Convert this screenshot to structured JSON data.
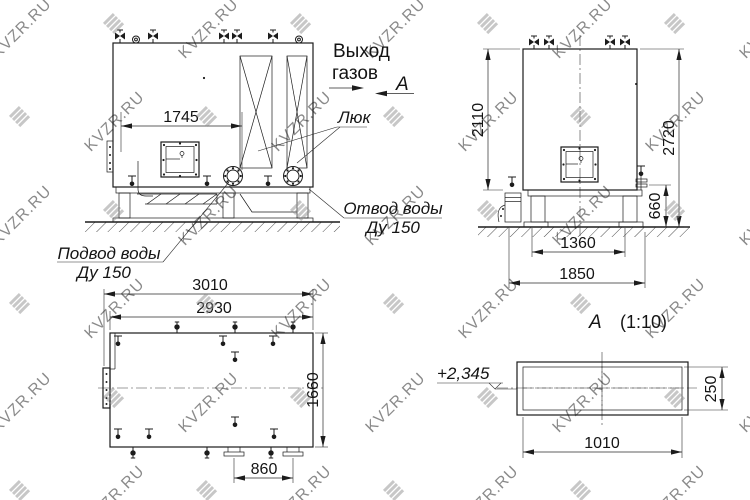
{
  "watermark": {
    "text": "KVZR.RU"
  },
  "labels": {
    "gas_outlet_1": "Выход",
    "gas_outlet_2": "газов",
    "section_arrow_letter": "А",
    "hatch": "Люк",
    "water_outlet_1": "Отвод воды",
    "water_outlet_2": "Ду 150",
    "water_inlet_1": "Подвод воды",
    "water_inlet_2": "Ду 150",
    "section_title_letter": "А",
    "section_title_scale": "(1:10)",
    "elevation": "+2,345"
  },
  "dimensions": {
    "front_width": "1745",
    "side_body_height": "2110",
    "side_overall_height": "2720",
    "side_base_height": "660",
    "side_base_inner_width": "1360",
    "side_base_overall_width": "1850",
    "top_overall_length": "3010",
    "top_body_length": "2930",
    "top_width": "1660",
    "top_pipe_spacing": "860",
    "section_width": "1010",
    "section_height": "250"
  }
}
